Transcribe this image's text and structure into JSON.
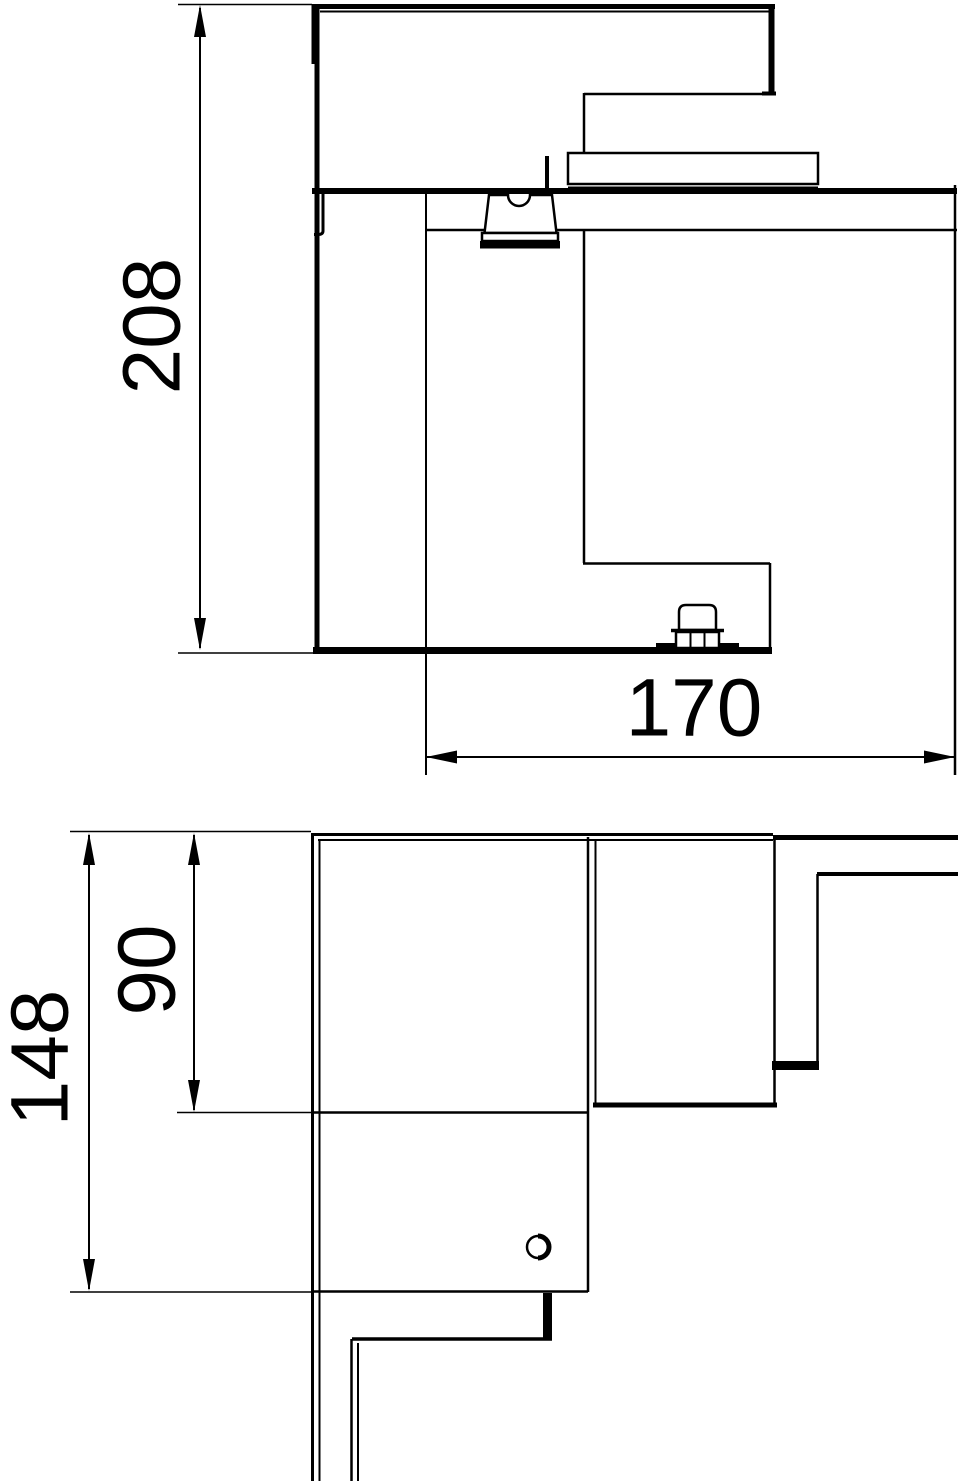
{
  "page": {
    "background_color": "#ffffff",
    "line_color": "#000000",
    "description": "Technical dimension drawing, external corner piece for wall trunking, two orthographic views"
  },
  "views": {
    "side_view": {
      "name": "side-section-view",
      "dimensions": {
        "height": {
          "label": "208",
          "orientation": "vertical"
        },
        "width": {
          "label": "170",
          "orientation": "horizontal"
        }
      }
    },
    "plan_view": {
      "name": "plan-view",
      "dimensions": {
        "overall_depth": {
          "label": "148",
          "orientation": "vertical"
        },
        "body_depth": {
          "label": "90",
          "orientation": "vertical"
        }
      }
    }
  }
}
